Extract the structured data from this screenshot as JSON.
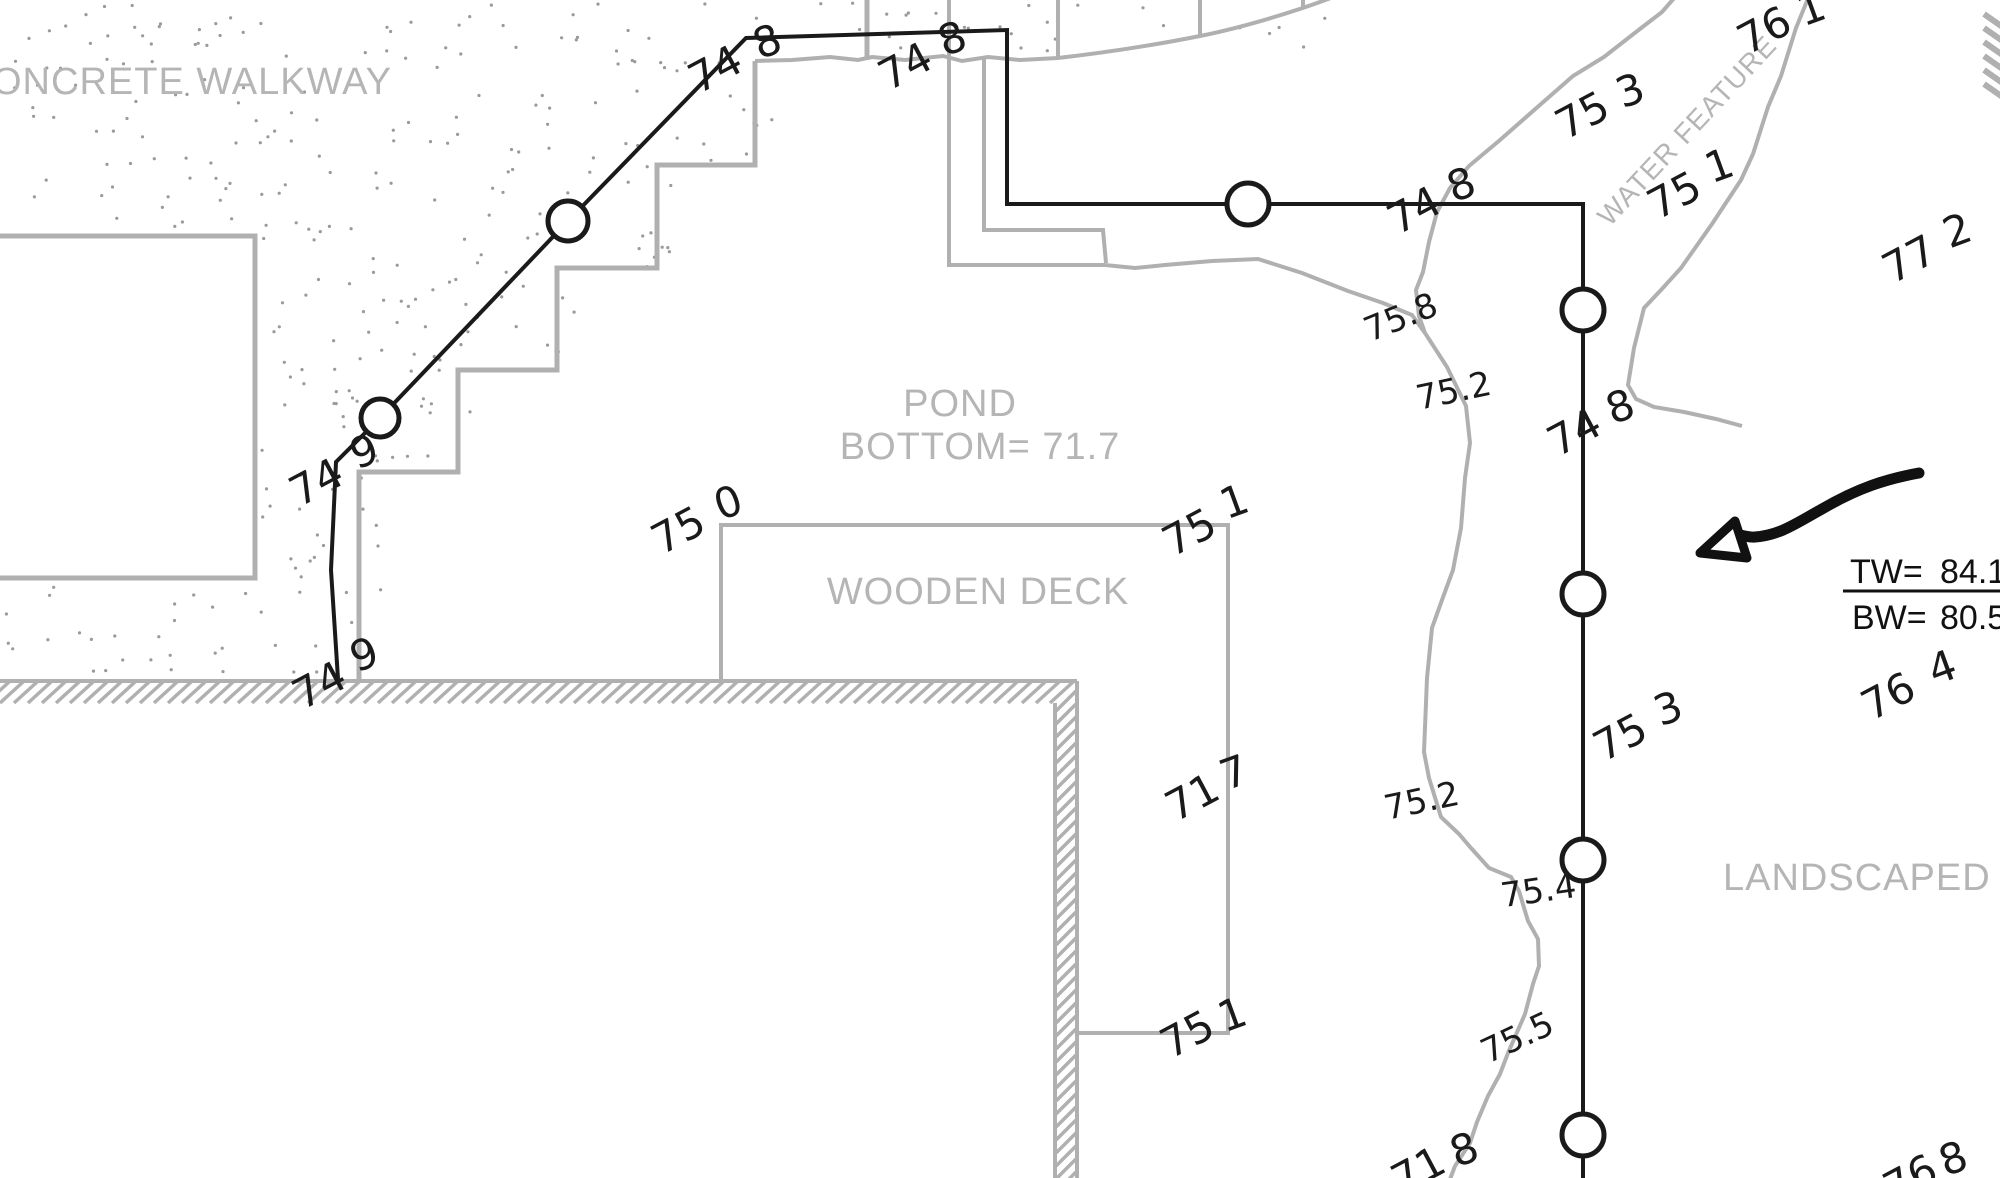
{
  "colors": {
    "line_black": "#1a1a1a",
    "line_gray": "#b0b0b0",
    "text_gray": "#b5b5b5",
    "dot_gray": "#9a9a9a"
  },
  "area_labels": {
    "concrete_walkway": "ONCRETE WALKWAY",
    "pond_name": "POND",
    "pond_bottom": "BOTTOM= 71.7",
    "wooden_deck": "WOODEN DECK",
    "water_feature": "WATER FEATURE",
    "landscaped_area": "LANDSCAPED AREA"
  },
  "wall_note": {
    "tw_label": "TW=",
    "tw_value": "84.1",
    "bw_label": "BW=",
    "bw_value": "80.5"
  },
  "spot_elevations": [
    {
      "main": "74",
      "dec": "8"
    },
    {
      "main": "74",
      "dec": "8"
    },
    {
      "main": "74",
      "dec": "8"
    },
    {
      "main": "75",
      "dec": "3"
    },
    {
      "main": "75",
      "dec": "1"
    },
    {
      "main": "77",
      "dec": "2"
    },
    {
      "main": "74",
      "dec": "8"
    },
    {
      "main": "74",
      "dec": "9"
    },
    {
      "main": "74",
      "dec": "9"
    },
    {
      "main": "75",
      "dec": "0"
    },
    {
      "main": "75",
      "dec": "1"
    },
    {
      "main": "71",
      "dec": "7"
    },
    {
      "main": "75",
      "dec": "1"
    },
    {
      "main": "75",
      "dec": "3"
    },
    {
      "main": "76",
      "dec": "4"
    },
    {
      "main": "76",
      "dec": "8"
    },
    {
      "main": "71",
      "dec": "8"
    },
    {
      "main": "76",
      "dec": "1"
    }
  ],
  "contour_labels": [
    {
      "value": "75.8"
    },
    {
      "value": "75.2"
    },
    {
      "value": "75.2"
    },
    {
      "value": "75.4"
    },
    {
      "value": "75.5"
    }
  ]
}
